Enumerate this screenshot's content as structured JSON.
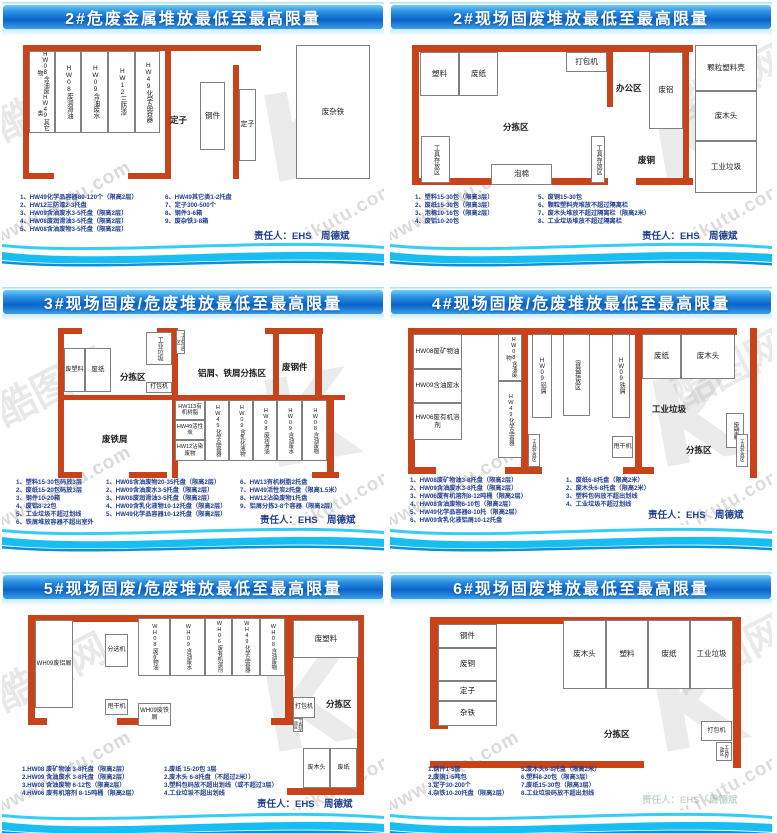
{
  "watermark": {
    "site": "www.ikutu.com",
    "brand": "酷图网",
    "logo": "K"
  },
  "colors": {
    "wall": "#c8431a",
    "title_blue": "#0b63c8",
    "wave_cyan": "#18bdf1",
    "note_text": "#23418f"
  },
  "panels": [
    {
      "title": "2#危废金属堆放最低至最高限量",
      "responsible": "责任人：EHS　周德斌",
      "map": {
        "walls": [
          [
            21,
            9,
            238,
            6
          ],
          [
            21,
            9,
            6,
            134
          ],
          [
            21,
            137,
            31,
            6
          ],
          [
            126,
            137,
            38,
            6
          ],
          [
            163,
            14,
            6,
            129
          ],
          [
            231,
            29,
            6,
            114
          ]
        ],
        "rooms": [
          {
            "t": "HW08含油废物",
            "t2": "HW49其它类",
            "x": 27,
            "y": 15,
            "w": 26,
            "h": 82,
            "v": 1,
            "fs": 6
          },
          {
            "t": "HW08废润滑油",
            "x": 53,
            "y": 15,
            "w": 26,
            "h": 82,
            "v": 1,
            "fs": 6.5
          },
          {
            "t": "HW09含油废水",
            "x": 79,
            "y": 15,
            "w": 27,
            "h": 82,
            "v": 1,
            "fs": 6.5
          },
          {
            "t": "HW12三防漆",
            "x": 106,
            "y": 15,
            "w": 27,
            "h": 82,
            "v": 1,
            "fs": 6.5
          },
          {
            "t": "HW49化学品容器",
            "x": 133,
            "y": 15,
            "w": 25,
            "h": 82,
            "v": 1,
            "fs": 6.5
          },
          {
            "t": "钢件",
            "x": 198,
            "y": 46,
            "w": 25,
            "h": 68
          },
          {
            "t": "定子",
            "x": 237,
            "y": 53,
            "w": 17,
            "h": 72,
            "fs": 7
          },
          {
            "t": "废杂铁",
            "x": 294,
            "y": 9,
            "w": 74,
            "h": 134
          }
        ],
        "labels": [
          {
            "t": "定子",
            "x": 168,
            "y": 78
          }
        ]
      },
      "notes": [
        [
          "1、HW49化学品容器80-120个（限高2层）",
          "2、HW12三防漆2-3托盘",
          "3、HW09含油废水3-5托盘（限高2层）",
          "4、HW08废润滑油3-5托盘（限高2层）",
          "5、HW08含油废物3-5托盘（限高2层）"
        ],
        [
          "6、HW49其它类1-2托盘",
          "7、定子300-500个",
          "8、钢件3-6箱",
          "9、废杂铁3-8箱"
        ]
      ]
    },
    {
      "title": "2#现场固废堆放最低至最高限量",
      "responsible": "责任人：EHS　周德斌",
      "map": {
        "walls": [
          [
            22,
            9,
            281,
            7
          ],
          [
            22,
            9,
            7,
            140
          ],
          [
            22,
            142,
            80,
            7
          ],
          [
            162,
            142,
            56,
            7
          ],
          [
            246,
            142,
            57,
            7
          ],
          [
            217,
            16,
            6,
            55
          ],
          [
            293,
            16,
            6,
            133
          ]
        ],
        "rooms": [
          {
            "t": "塑料",
            "x": 30,
            "y": 16,
            "w": 39,
            "h": 44
          },
          {
            "t": "废纸",
            "x": 69,
            "y": 16,
            "w": 39,
            "h": 44
          },
          {
            "t": "打包机",
            "x": 176,
            "y": 16,
            "w": 41,
            "h": 20
          },
          {
            "t": "工具存放区",
            "x": 31,
            "y": 100,
            "w": 29,
            "h": 47,
            "v": 1,
            "fs": 6
          },
          {
            "t": "泡棉",
            "x": 101,
            "y": 128,
            "w": 61,
            "h": 21
          },
          {
            "t": "废铝",
            "x": 259,
            "y": 16,
            "w": 34,
            "h": 77
          },
          {
            "t": "工具存放区",
            "x": 201,
            "y": 100,
            "w": 14,
            "h": 47,
            "v": 1,
            "fs": 6
          },
          {
            "t": "颗粒塑料壳",
            "x": 305,
            "y": 9,
            "w": 62,
            "h": 46
          },
          {
            "t": "废木头",
            "x": 305,
            "y": 55,
            "w": 62,
            "h": 50
          },
          {
            "t": "工业垃圾",
            "x": 305,
            "y": 105,
            "w": 62,
            "h": 52
          }
        ],
        "labels": [
          {
            "t": "分拣区",
            "x": 113,
            "y": 85
          },
          {
            "t": "办公区",
            "x": 226,
            "y": 46
          },
          {
            "t": "废铜",
            "x": 248,
            "y": 118
          }
        ]
      },
      "notes": [
        [
          "1、塑料15-30包（限高3层）",
          "2、废纸15-30包（限高3层）",
          "3、泡棉10-16包（限高2层）",
          "4、废铝10-20包"
        ],
        [
          "5、废铜15-30包",
          "6、颗粒塑料壳堆放不超过隔离栏",
          "7、废木头堆放不超过隔离栏（限高2米）",
          "8、工业垃圾堆放不超过隔离栏"
        ]
      ]
    },
    {
      "title": "3#现场固废/危废堆放最低至最高限量",
      "responsible": "责任人：EHS　周德斌",
      "map": {
        "walls": [
          [
            56,
            7,
            24,
            6
          ],
          [
            56,
            7,
            6,
            150
          ],
          [
            56,
            151,
            24,
            6
          ],
          [
            155,
            7,
            21,
            6
          ],
          [
            170,
            7,
            6,
            150
          ],
          [
            127,
            151,
            38,
            6
          ],
          [
            56,
            74,
            287,
            5
          ],
          [
            263,
            7,
            58,
            6
          ],
          [
            271,
            7,
            6,
            72
          ],
          [
            313,
            7,
            7,
            67
          ],
          [
            325,
            74,
            7,
            83
          ],
          [
            310,
            151,
            27,
            6
          ]
        ],
        "rooms": [
          {
            "t": "废塑料",
            "x": 62,
            "y": 27,
            "w": 21,
            "h": 44,
            "fs": 6
          },
          {
            "t": "废纸",
            "x": 83,
            "y": 27,
            "w": 26,
            "h": 44,
            "fs": 6.5
          },
          {
            "t": "工业垃圾",
            "x": 144,
            "y": 11,
            "w": 26,
            "h": 33,
            "v": 1,
            "fs": 6
          },
          {
            "t": "工具存放区",
            "x": 174,
            "y": 9,
            "w": 9,
            "h": 24,
            "v": 1,
            "fs": 4.5
          },
          {
            "t": "打包机",
            "x": 144,
            "y": 61,
            "w": 26,
            "h": 11,
            "fs": 6
          },
          {
            "t": "HW113有机树脂",
            "x": 173,
            "y": 79,
            "w": 30,
            "h": 20,
            "fs": 5.5
          },
          {
            "t": "HW49活性炭",
            "x": 173,
            "y": 99,
            "w": 30,
            "h": 20,
            "fs": 5.5
          },
          {
            "t": "HW12沾染废物",
            "x": 173,
            "y": 119,
            "w": 30,
            "h": 21,
            "fs": 5.5
          },
          {
            "t": "HW49化学品容器",
            "x": 203,
            "y": 79,
            "w": 24,
            "h": 61,
            "v": 1,
            "fs": 5.5
          },
          {
            "t": "HW09含乳化液物",
            "x": 227,
            "y": 79,
            "w": 24,
            "h": 61,
            "v": 1,
            "fs": 5.5
          },
          {
            "t": "HW08废润滑油",
            "x": 251,
            "y": 79,
            "w": 24,
            "h": 61,
            "v": 1,
            "fs": 5.5
          },
          {
            "t": "HW09含油废水",
            "x": 275,
            "y": 79,
            "w": 25,
            "h": 61,
            "v": 1,
            "fs": 5.5
          },
          {
            "t": "HW08含油废物",
            "x": 300,
            "y": 79,
            "w": 25,
            "h": 61,
            "v": 1,
            "fs": 5.5
          }
        ],
        "labels": [
          {
            "t": "分拣区",
            "x": 118,
            "y": 50
          },
          {
            "t": "铝屑、铁屑分拣区",
            "x": 196,
            "y": 46
          },
          {
            "t": "废钢件",
            "x": 280,
            "y": 40
          },
          {
            "t": "废铁屑",
            "x": 100,
            "y": 112
          }
        ]
      },
      "notes": [
        [
          "1、塑料15-30包码放3层",
          "2、废纸15-20包码放3层",
          "3、钢件10-20箱",
          "4、废铝8-22包",
          "5、工业垃圾不超过划线",
          "6、铁屑堆放容器不超出室外"
        ],
        [
          "1、HW08含油废物20-35托盘（限高2层）",
          "2、HW09含油废水3-5托盘（限高2层）",
          "3、HW08废润滑油3-5托盘（限高2层）",
          "4、HW09含乳化液物10-12托盘（限高2层）",
          "5、HW49化学品容器10-12托盘（限高2层）"
        ],
        [
          "6、HW13有机树脂2托盘",
          "7、HW49活性炭2托盘（限高1.5米）",
          "8、HW12沾染废物1托盘",
          "9、铝屑分拣3-8个容器（限高2层）"
        ]
      ]
    },
    {
      "title": "4#现场固废/危废堆放最低至最高限量",
      "responsible": "责任人：EHS　周德斌",
      "map": {
        "walls": [
          [
            18,
            7,
            329,
            7
          ],
          [
            18,
            7,
            7,
            146
          ],
          [
            18,
            146,
            28,
            7
          ],
          [
            131,
            7,
            7,
            146
          ],
          [
            115,
            146,
            37,
            7
          ],
          [
            245,
            7,
            7,
            146
          ],
          [
            233,
            146,
            31,
            7
          ],
          [
            360,
            7,
            7,
            150
          ]
        ],
        "rooms": [
          {
            "t": "HW08废矿物油",
            "x": 23,
            "y": 13,
            "w": 49,
            "h": 35,
            "fs": 6.5
          },
          {
            "t": "HW09含油废水",
            "x": 23,
            "y": 48,
            "w": 49,
            "h": 34,
            "fs": 6.5
          },
          {
            "t": "HW06废有机溶剂",
            "x": 23,
            "y": 82,
            "w": 49,
            "h": 37,
            "fs": 6.5
          },
          {
            "t": "HW08含油废物",
            "x": 108,
            "y": 13,
            "w": 24,
            "h": 47,
            "v": 1,
            "fs": 5.5
          },
          {
            "t": "HW49化学品容器",
            "x": 108,
            "y": 60,
            "w": 24,
            "h": 77,
            "v": 1,
            "fs": 5.5
          },
          {
            "t": "工具存放区",
            "x": 138,
            "y": 113,
            "w": 12,
            "h": 33,
            "v": 1,
            "fs": 4.5
          },
          {
            "t": "HW09铝屑",
            "x": 142,
            "y": 13,
            "w": 20,
            "h": 84,
            "v": 1,
            "fs": 6
          },
          {
            "t": "容器摆放区",
            "x": 173,
            "y": 13,
            "w": 27,
            "h": 82,
            "v": 1,
            "fs": 6
          },
          {
            "t": "HW09铁屑",
            "x": 222,
            "y": 13,
            "w": 18,
            "h": 84,
            "v": 1,
            "fs": 6
          },
          {
            "t": "甩干机",
            "x": 222,
            "y": 115,
            "w": 21,
            "h": 22,
            "fs": 6
          },
          {
            "t": "废纸",
            "x": 252,
            "y": 13,
            "w": 39,
            "h": 45
          },
          {
            "t": "废木头",
            "x": 291,
            "y": 13,
            "w": 54,
            "h": 45
          },
          {
            "t": "废塑料",
            "x": 336,
            "y": 92,
            "w": 18,
            "h": 35,
            "v": 1,
            "fs": 6
          },
          {
            "t": "工具存放区",
            "x": 346,
            "y": 113,
            "w": 12,
            "h": 33,
            "v": 1,
            "fs": 4.5
          }
        ],
        "labels": [
          {
            "t": "工业垃圾",
            "x": 262,
            "y": 82
          },
          {
            "t": "分拣区",
            "x": 296,
            "y": 123
          }
        ]
      },
      "notes": [
        [
          "1、HW08废矿物油3-8托盘（限高2层）",
          "2、HW09含油废水3-8托盘（限高2层）",
          "3、HW06废有机溶剂8-12吨桶（限高2层）",
          "4、HW08含油废物6-10包（限高2层）",
          "5、HW49化学品容器8-10托（限高2层）",
          "6、HW09含乳化液铝屑10-12托盘"
        ],
        [
          "1、废纸6-8托盘（限高2米）",
          "2、废木头6-8托盘（限高2米）",
          "3、塑料包码放不超出划线",
          "4、工业垃圾不超过划线"
        ]
      ]
    },
    {
      "title": "5#现场固废/危废堆放最低至最高限量",
      "responsible": "责任人：EHS　周德斌",
      "map": {
        "walls": [
          [
            26,
            9,
            336,
            7
          ],
          [
            26,
            9,
            7,
            110
          ],
          [
            26,
            112,
            19,
            7
          ],
          [
            115,
            112,
            38,
            7
          ],
          [
            283,
            9,
            8,
            110
          ],
          [
            269,
            112,
            22,
            7
          ],
          [
            355,
            9,
            7,
            180
          ],
          [
            285,
            182,
            77,
            7
          ]
        ],
        "rooms": [
          {
            "t": "WH09废铝屑",
            "x": 33,
            "y": 14,
            "w": 38,
            "h": 88,
            "fs": 6
          },
          {
            "t": "分选机",
            "x": 103,
            "y": 28,
            "w": 23,
            "h": 33,
            "fs": 6
          },
          {
            "t": "甩干机",
            "x": 103,
            "y": 93,
            "w": 23,
            "h": 16,
            "fs": 6
          },
          {
            "t": "WH09废铁屑",
            "x": 136,
            "y": 97,
            "w": 33,
            "h": 23,
            "fs": 6
          },
          {
            "t": "WH08废矿物油",
            "x": 136,
            "y": 12,
            "w": 32,
            "h": 58,
            "v": 1,
            "fs": 5.5
          },
          {
            "t": "WH09含油废水",
            "x": 168,
            "y": 12,
            "w": 35,
            "h": 58,
            "v": 1,
            "fs": 5.5
          },
          {
            "t": "WH06废有机溶剂",
            "x": 203,
            "y": 12,
            "w": 27,
            "h": 58,
            "v": 1,
            "fs": 5.5
          },
          {
            "t": "WH49化学品容器",
            "x": 230,
            "y": 12,
            "w": 28,
            "h": 58,
            "v": 1,
            "fs": 5.5
          },
          {
            "t": "WH08含油废物",
            "x": 258,
            "y": 12,
            "w": 25,
            "h": 58,
            "v": 1,
            "fs": 5.5
          },
          {
            "t": "废塑料",
            "x": 291,
            "y": 14,
            "w": 66,
            "h": 38
          },
          {
            "t": "打包机",
            "x": 291,
            "y": 91,
            "w": 22,
            "h": 21,
            "fs": 6
          },
          {
            "t": "工具存放区",
            "x": 291,
            "y": 112,
            "w": 10,
            "h": 14,
            "v": 1,
            "fs": 4
          },
          {
            "t": "废木头",
            "x": 301,
            "y": 142,
            "w": 27,
            "h": 40,
            "fs": 6
          },
          {
            "t": "废纸",
            "x": 328,
            "y": 142,
            "w": 27,
            "h": 40,
            "fs": 6
          }
        ],
        "labels": [
          {
            "t": "分拣区",
            "x": 324,
            "y": 92
          }
        ]
      },
      "notes": [
        [
          "1.HW08 废矿物油 3-8托盘（限高2层）",
          "2.HW09 含油废水 3-8托盘（限高2层）",
          "3.HW08 含油废物 6-12包（限高2层）",
          "4.HW06 废有机溶剂 8-15吨桶（限高2层）"
        ],
        [
          "1.废纸 15-20包 3层",
          "2.废木头 6-8托盘（不超过2米））",
          "3.塑料包码放不超出划线（或不超过3层）",
          "4.工业垃圾不超出划线"
        ]
      ]
    },
    {
      "title": "6#现场固废堆放最低至最高限量",
      "responsible": "责任人：EHS　周德斌",
      "map": {
        "walls": [
          [
            40,
            11,
            307,
            7
          ],
          [
            40,
            11,
            8,
            112
          ],
          [
            40,
            116,
            18,
            7
          ],
          [
            40,
            155,
            214,
            7
          ],
          [
            343,
            11,
            8,
            151
          ]
        ],
        "rooms": [
          {
            "t": "钢件",
            "x": 48,
            "y": 18,
            "w": 59,
            "h": 24
          },
          {
            "t": "废铜",
            "x": 48,
            "y": 42,
            "w": 59,
            "h": 33
          },
          {
            "t": "定子",
            "x": 48,
            "y": 75,
            "w": 59,
            "h": 20
          },
          {
            "t": "杂铁",
            "x": 48,
            "y": 95,
            "w": 59,
            "h": 25
          },
          {
            "t": "废木头",
            "x": 173,
            "y": 14,
            "w": 43,
            "h": 69
          },
          {
            "t": "塑料",
            "x": 216,
            "y": 14,
            "w": 42,
            "h": 69
          },
          {
            "t": "废纸",
            "x": 258,
            "y": 14,
            "w": 42,
            "h": 69
          },
          {
            "t": "工业垃圾",
            "x": 300,
            "y": 14,
            "w": 43,
            "h": 69
          },
          {
            "t": "打包机",
            "x": 311,
            "y": 115,
            "w": 31,
            "h": 20,
            "fs": 6
          },
          {
            "t": "工具存放区",
            "x": 326,
            "y": 136,
            "w": 16,
            "h": 19,
            "v": 1,
            "fs": 4.5
          }
        ],
        "labels": [
          {
            "t": "分拣区",
            "x": 214,
            "y": 122
          }
        ]
      },
      "notes": [
        [
          "1.钢件1-5筐",
          "2.废铜1-5吨包",
          "3.定子30-200个",
          "4.杂铁10-20托盘（限高2层）"
        ],
        [
          "5.废木头6-8托盘（限高2米）",
          "6.塑料8-20包（限高3层）",
          "7.废纸15-30包（限高3层）",
          "8.工业垃圾码放不超出划线"
        ]
      ]
    }
  ]
}
